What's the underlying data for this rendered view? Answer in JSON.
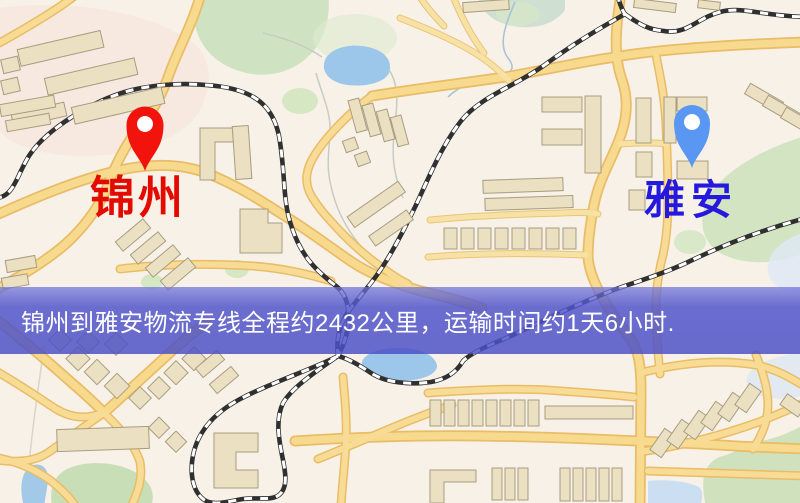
{
  "map": {
    "origin": {
      "label": "锦州",
      "label_color": "#e30b00",
      "pin_color": "#f3130d",
      "pin_hole_color": "#ffffff"
    },
    "destination": {
      "label": "雅安",
      "label_color": "#2419dd",
      "pin_color": "#5a97f2",
      "pin_hole_color": "#ffffff"
    },
    "style_colors": {
      "background": "#f7f1e7",
      "road_fill": "#f8da8e",
      "road_casing": "#e9bc67",
      "building_fill": "#ebe0c1",
      "park_green": "#cfe3c2",
      "water_blue": "#9cc6ea",
      "railway_dark": "#303030"
    }
  },
  "banner": {
    "text": "锦州到雅安物流专线全程约2432公里，运输时间约1天6小时.",
    "bg_color": "#5054cd",
    "text_color": "#ffffff"
  }
}
